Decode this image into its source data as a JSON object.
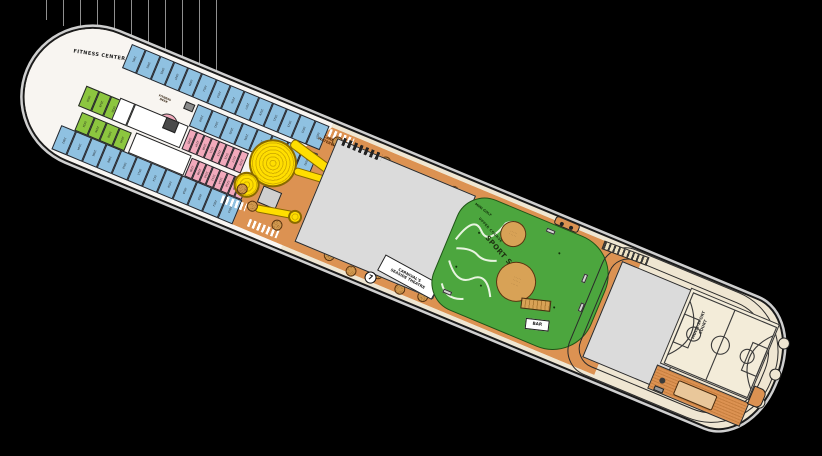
{
  "title": "cruise-ship-deck-plan",
  "bow": {
    "fitness_center_label": "FITNESS CENTER",
    "fitness_desk_line1": "FITNESS",
    "fitness_desk_line2": "DESK",
    "cabins": {
      "top_outer": [
        "2001",
        "2003",
        "2005",
        "2007",
        "2009",
        "2011",
        "2013",
        "2015",
        "2017",
        "2019",
        "2021",
        "2023",
        "2025",
        "2027"
      ],
      "top_inner": [
        "2029",
        "2031",
        "2033",
        "2035",
        "2037",
        "2039",
        "2041",
        "2043"
      ],
      "bottom_outer": [
        "2002",
        "2004",
        "2006",
        "2008",
        "2010",
        "2012",
        "2014",
        "2016",
        "2018",
        "2020",
        "2022",
        "2024"
      ],
      "mid_upper_green": [
        "2026",
        "2028",
        "2030",
        "2032"
      ],
      "mid_upper_pink": [
        "2205",
        "2207",
        "2209",
        "2211",
        "2213",
        "2215",
        "2217",
        "2219"
      ],
      "mid_lower_green": [
        "2034",
        "2036",
        "2038",
        "2040"
      ],
      "mid_lower_pink": [
        "2206",
        "2208",
        "2210",
        "2212",
        "2214",
        "2216",
        "2218",
        "2220"
      ]
    }
  },
  "waterworks": {
    "label_line1": "CARNIVAL",
    "label_line2": "WATERWORKS"
  },
  "theatre": {
    "label_line1": "CARNIVAL'S",
    "label_line2": "SEASIDE THEATRE"
  },
  "deck_marker": "7",
  "sportsquare": {
    "mini_golf_label": "MINI GOLF",
    "upper_course_label": "UPPER COURSE",
    "sport_square_label": "SPORT SQUARE",
    "bar_label": "BAR",
    "circle_markings_row": "· · · · ·"
  },
  "stern": {
    "court_label_line1": "MULTI-SPORT",
    "court_label_line2": "COURT"
  },
  "colors": {
    "background": "#000000",
    "deck_cream": "#efe6d2",
    "bow_white": "#f8f5f1",
    "deck_orange": "#dc9252",
    "slide_yellow": "#ffde00",
    "cabin_blue": "#8fc1e1",
    "cabin_pink": "#f2a9bb",
    "cabin_green": "#8cc63f",
    "sport_green": "#4ca63e",
    "open_gray": "#dbdbdb",
    "umbrella_tan": "#cf974e"
  }
}
